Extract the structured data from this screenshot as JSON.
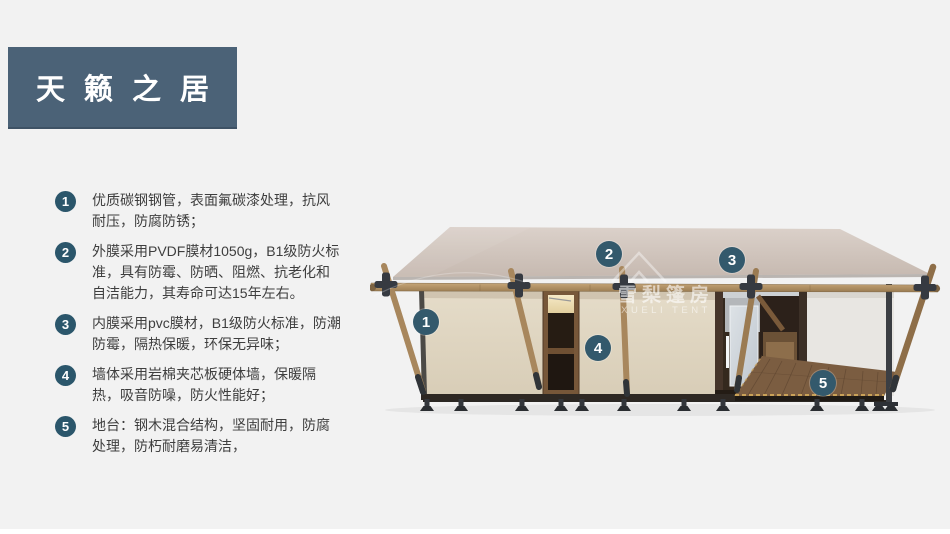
{
  "slide": {
    "background": "#f2f2f2",
    "title": {
      "text": "天籁之居",
      "bg_color": "#4b6277",
      "text_color": "#ffffff"
    },
    "feature_badge_color": "#2b566b",
    "features": [
      {
        "num": "1",
        "text": "优质碳钢钢管，表面氟碳漆处理，抗风耐压，防腐防锈；"
      },
      {
        "num": "2",
        "text": "外膜采用PVDF膜材1050g，B1级防火标准，具有防霉、防晒、阻燃、抗老化和自洁能力，其寿命可达15年左右。"
      },
      {
        "num": "3",
        "text": "内膜采用pvc膜材，B1级防火标准，防潮防霉，隔热保暖，环保无异味；"
      },
      {
        "num": "4",
        "text": "墙体采用岩棉夹芯板硬体墙，保暖隔热，吸音防噪，防火性能好；"
      },
      {
        "num": "5",
        "text": "地台：钢木混合结构，坚固耐用，防腐处理，防朽耐磨易清洁，"
      }
    ],
    "illustration": {
      "type": "glamping-tent-3d-render",
      "callout_color": "#33596c",
      "callouts": [
        {
          "num": "1"
        },
        {
          "num": "2"
        },
        {
          "num": "3"
        },
        {
          "num": "4"
        },
        {
          "num": "5"
        }
      ],
      "watermark": {
        "cn": "雪梨篷房",
        "en": "XUELI TENT"
      },
      "palette": {
        "roof": "#cfc3ba",
        "wall": "#e0d6c2",
        "wood_pole": "#a8875d",
        "deck": "#7b5d41",
        "metal_frame": "#34383d",
        "door_wood": "#775739"
      }
    }
  }
}
